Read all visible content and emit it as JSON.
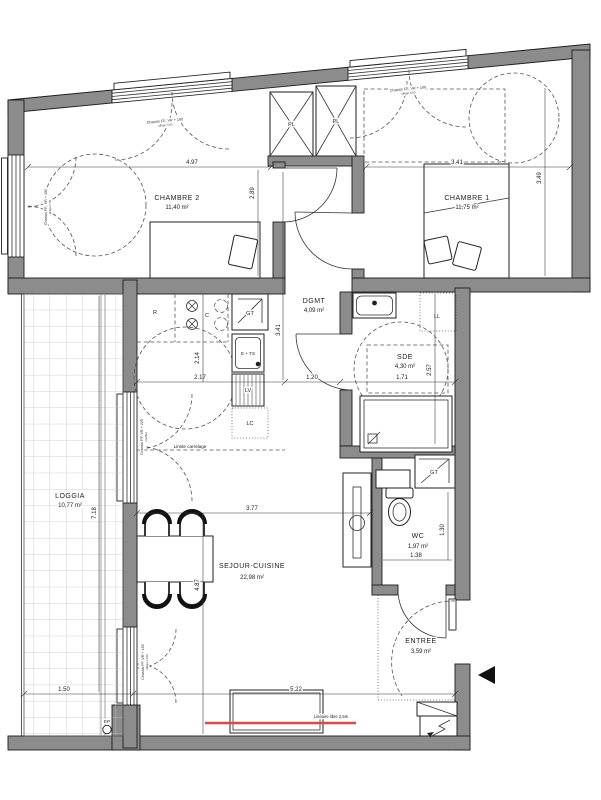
{
  "rooms": {
    "chambre2": {
      "name": "CHAMBRE 2",
      "area": "11,40 m²"
    },
    "chambre1": {
      "name": "CHAMBRE 1",
      "area": "11,75 m²"
    },
    "dgmt": {
      "name": "DGMT",
      "area": "4,09 m²"
    },
    "sde": {
      "name": "SDE",
      "area": "4,30 m²"
    },
    "sejour_cuisine": {
      "name": "SEJOUR-CUISINE",
      "area": "22,98 m²"
    },
    "loggia": {
      "name": "LOGGIA",
      "area": "10,77 m²"
    },
    "wc": {
      "name": "WC",
      "area": "1,97 m²"
    },
    "entree": {
      "name": "ENTREE",
      "area": "3,59 m²"
    }
  },
  "dims": {
    "chambre2_w": "4.97",
    "chambre2_h": "2.89",
    "chambre1_w": "3.41",
    "chambre1_h": "3.49",
    "dgmt_h": "3.41",
    "dgmt_w": "1.20",
    "sde_w": "1.71",
    "sde_h": "2.57",
    "kitchen_w": "2.17",
    "kitchen_h": "2.14",
    "sejour_w": "3.77",
    "sejour_h": "4.87",
    "sejour_bottom": "5.22",
    "wc_w": "1.38",
    "wc_h": "1.30",
    "loggia_h": "7.18",
    "loggia_w": "1.50"
  },
  "equipment": {
    "placard": "PL",
    "lave_linge": "LL",
    "gaine_technique": "GT",
    "refrigerateur": "R",
    "cuisson": "C",
    "evier_tri": "E + TS",
    "lave_vaisselle": "LV",
    "lave_colonne": "LC",
    "eaux_pluviales": "EP"
  },
  "windows": {
    "chambre2_top": {
      "line1": "Chassis FE, VR + 180",
      "line2": "allège h:50"
    },
    "chambre2_left": {
      "line1": "Chassis FE, VR + 180",
      "line2": "allège h:50"
    },
    "chambre1_top": {
      "line1": "Chassis FE, VR + 180",
      "line2": "allège h:50"
    },
    "sejour_loggia_upper": {
      "line1": "Chassis PF, VR + 225",
      "line2": "soufflet"
    },
    "sejour_loggia_lower": {
      "line1": "Chassis FF, VR + 150",
      "line2": "allège h:100"
    }
  },
  "annotations": {
    "limite_carrelage": "Limite carrelage",
    "lineaire_libre": "Linéaire libre 2,5m"
  },
  "colors": {
    "wall": "#8c8c8c",
    "accent_red": "#e04848"
  }
}
